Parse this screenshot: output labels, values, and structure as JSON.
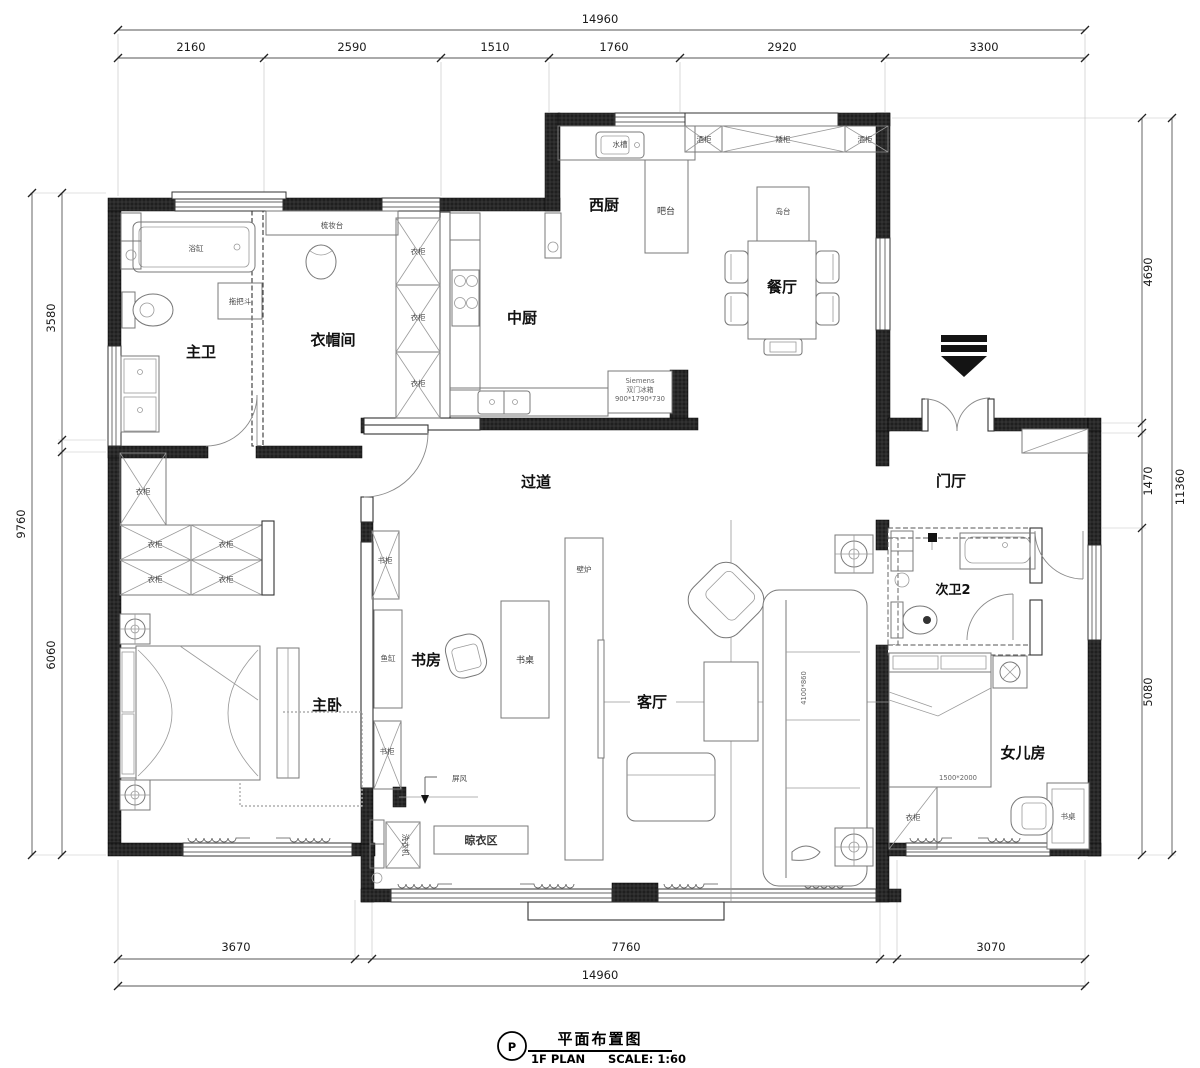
{
  "dimensions": {
    "top": {
      "total": "14960",
      "segments": [
        "2160",
        "2590",
        "1510",
        "1760",
        "2920",
        "3300"
      ]
    },
    "bottom": {
      "total": "14960",
      "segments": [
        "3670",
        "7760",
        "3070"
      ]
    },
    "left": {
      "total": "9760",
      "segments": [
        "3580",
        "6060"
      ]
    },
    "right": {
      "total": "11360",
      "segments": [
        "4690",
        "1470",
        "5080"
      ]
    }
  },
  "rooms": {
    "master_bath": "主卫",
    "closet": "衣帽间",
    "west_kitchen": "西厨",
    "chinese_kitchen": "中厨",
    "dining": "餐厅",
    "corridor": "过道",
    "foyer": "门厅",
    "study": "书房",
    "living": "客厅",
    "master_bedroom": "主卧",
    "bath2": "次卫2",
    "daughter": "女儿房",
    "drying": "晾衣区"
  },
  "labels": {
    "bathtub": "浴缸",
    "mop_sink": "拖把斗",
    "dresser": "梳妆台",
    "wardrobe": "衣柜",
    "sink": "水槽",
    "wine_cabinet": "酒柜",
    "low_cabinet": "矮柜",
    "bar": "吧台",
    "island": "岛台",
    "fireplace": "壁炉",
    "bookcase": "书柜",
    "fish_tank": "鱼缸",
    "desk": "书桌",
    "screen": "屏风",
    "washer": "洗衣机",
    "fridge_brand": "Siemens",
    "fridge_name": "双门冰箱",
    "fridge_size": "900*1790*730",
    "sofa_size": "4100*860",
    "bed_size": "1500*2000"
  },
  "title_block": {
    "symbol": "P",
    "title": "平面布置图",
    "plan": "1F PLAN",
    "scale": "SCALE: 1:60"
  },
  "colors": {
    "wall": "#141414",
    "line": "#555555",
    "furniture": "#787878",
    "text": "#1a1a1a"
  }
}
